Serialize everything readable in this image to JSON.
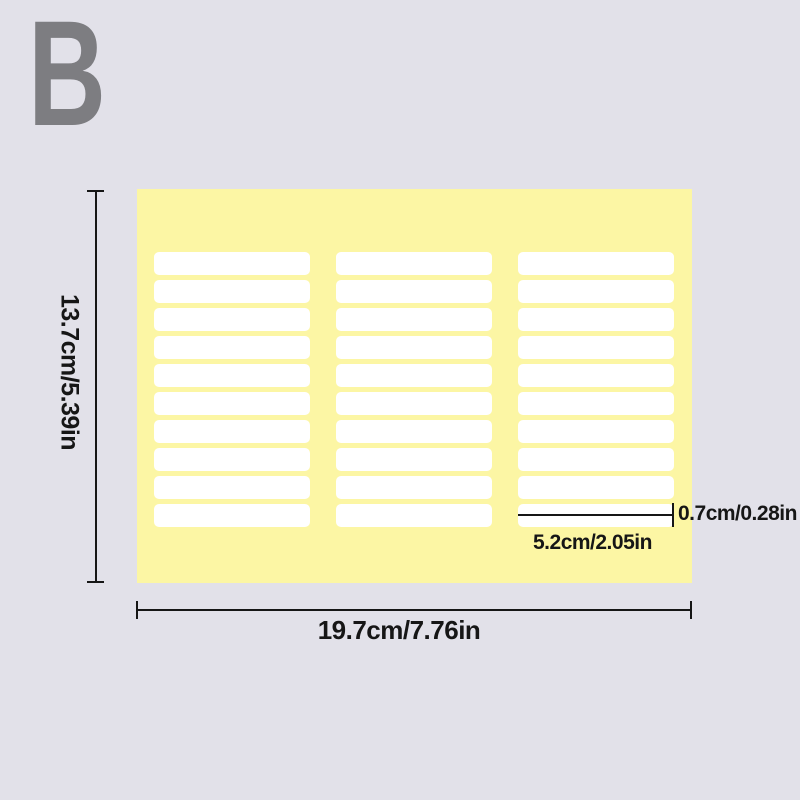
{
  "variant": {
    "label": "B"
  },
  "colors": {
    "background": "#e2e1e9",
    "sheet": "#fcf6a4",
    "label": "#ffffff",
    "variant_gray": "#7d7d81",
    "annotation": "#161616"
  },
  "sheet": {
    "columns": 3,
    "rows": 10
  },
  "dimensions": {
    "sheet_height": "13.7cm/5.39in",
    "sheet_width": "19.7cm/7.76in",
    "label_height": "0.7cm/0.28in",
    "label_width": "5.2cm/2.05in"
  }
}
